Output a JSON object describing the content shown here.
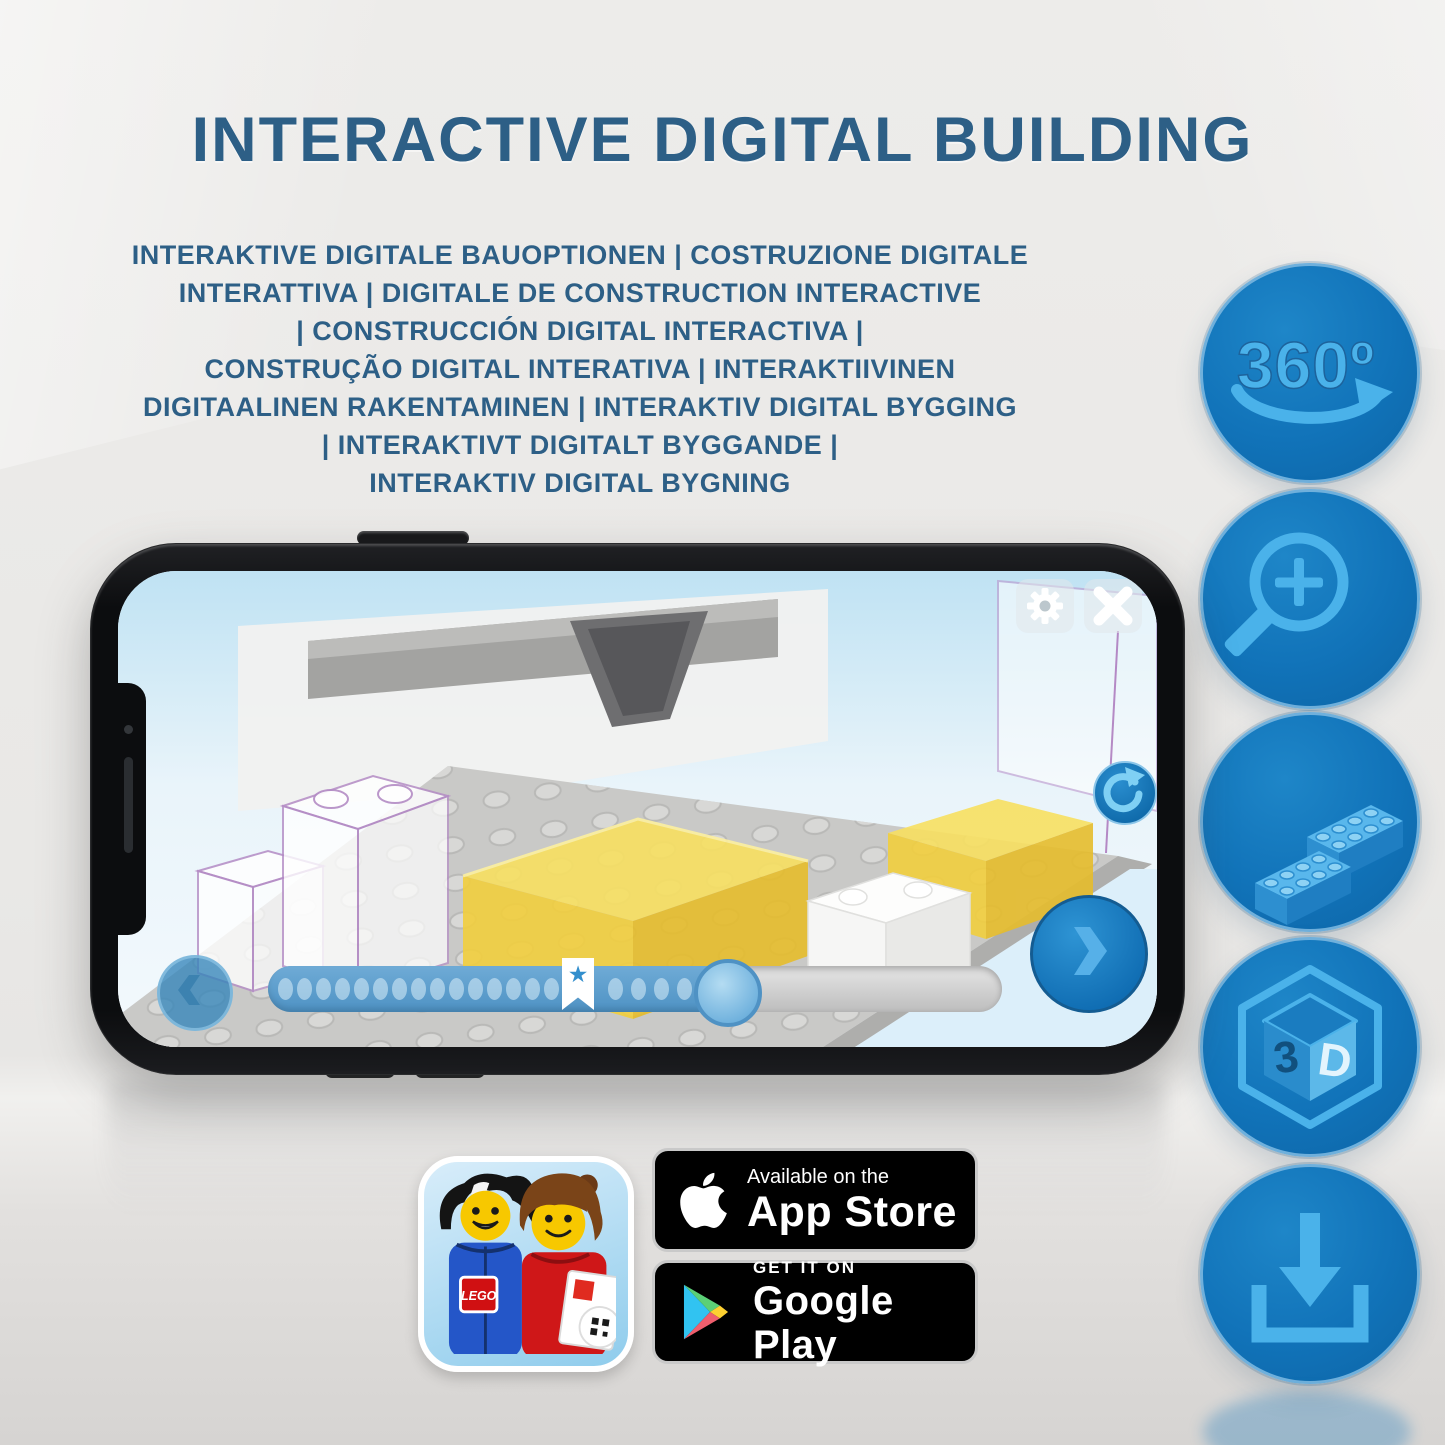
{
  "title": "INTERACTIVE DIGITAL BUILDING",
  "subtitle_lines": [
    "INTERAKTIVE DIGITALE BAUOPTIONEN | COSTRUZIONE DIGITALE",
    "INTERATTIVA | DIGITALE DE CONSTRUCTION INTERACTIVE",
    "| CONSTRUCCIÓN DIGITAL INTERACTIVA |",
    "CONSTRUÇÃO DIGITAL INTERATIVA | INTERAKTIIVINEN",
    "DIGITAALINEN RAKENTAMINEN | INTERAKTIV DIGITAL BYGGING",
    "| INTERAKTIVT DIGITALT BYGGANDE |",
    "INTERAKTIV DIGITAL BYGNING"
  ],
  "features": {
    "deg360_label": "360º",
    "cube_digit": "3",
    "cube_letter": "D"
  },
  "phone_app": {
    "progress": {
      "dots_before_bookmark": 16,
      "dots_after_bookmark": 4
    }
  },
  "store": {
    "lego_logo": "LEGO",
    "app_store_tagline": "Available on the",
    "app_store_name": "App Store",
    "google_play_tagline": "GET IT ON",
    "google_play_name": "Google Play"
  },
  "colors": {
    "title_blue": "#2d5f86",
    "circle_blue": "#1173b9",
    "glyph_blue": "#4ab2ea",
    "brick_yellow": "#f2cf3e"
  }
}
